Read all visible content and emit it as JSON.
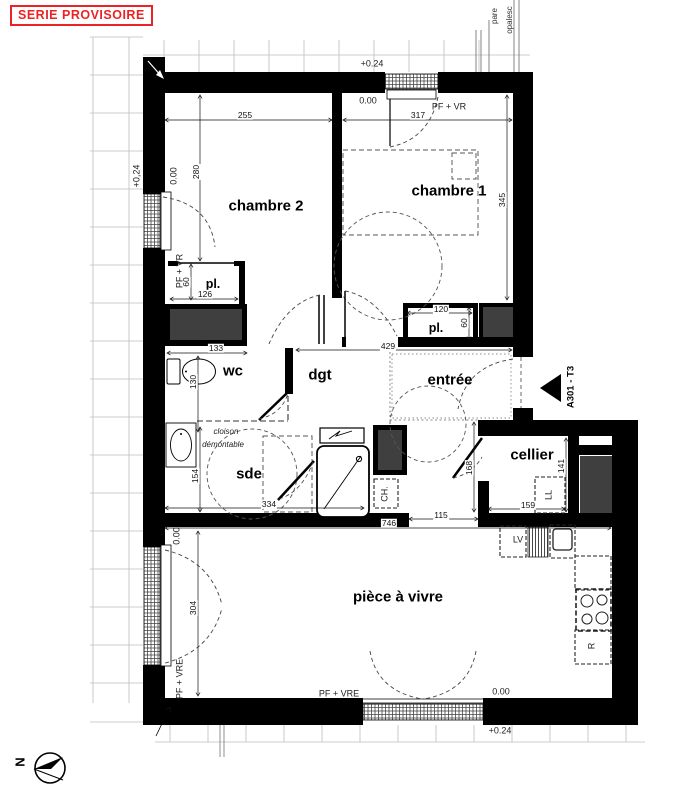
{
  "stamp": {
    "label": "SERIE PROVISOIRE",
    "color": "#ec2224"
  },
  "compass": {
    "north": "N"
  },
  "rooms": {
    "chambre2": "chambre 2",
    "chambre1": "chambre 1",
    "pl_a": "pl.",
    "pl_b": "pl.",
    "wc": "wc",
    "dgt": "dgt",
    "entree": "entrée",
    "cellier": "cellier",
    "sde": "sde",
    "piece_a_vivre": "pièce à vivre"
  },
  "fixtures": {
    "ll": "LL",
    "lv": "LV",
    "ch": "CH.",
    "r": "R"
  },
  "dims": {
    "d255": "255",
    "d317": "317",
    "d280": "280",
    "d345": "345",
    "d126": "126",
    "d60a": "60",
    "d60b": "60",
    "d133": "133",
    "d130": "130",
    "d429": "429",
    "d120": "120",
    "d154": "154",
    "d334": "334",
    "d115": "115",
    "d746": "746",
    "d159": "159",
    "d141": "141",
    "d168": "168",
    "d304": "304"
  },
  "levels": {
    "top_plus": "+0.24",
    "top_zero": "0.00",
    "left_plus": "+0,24",
    "left_zero_ch2": "0.00",
    "left_zero_piece": "0.00",
    "bottom_zero": "0.00",
    "bottom_plus": "+0.24"
  },
  "annotations": {
    "pf_vr_top": "PF + VR",
    "pf_vr_left": "PF + VR",
    "pf_vre_left": "PF + VRE",
    "pf_vre_bottom": "PF + VRE",
    "cloison_line1": "cloison",
    "cloison_line2": "démontable",
    "party_note_1": "pare",
    "party_note_2": "opalesc",
    "plan_marker": "A301 - T3"
  }
}
